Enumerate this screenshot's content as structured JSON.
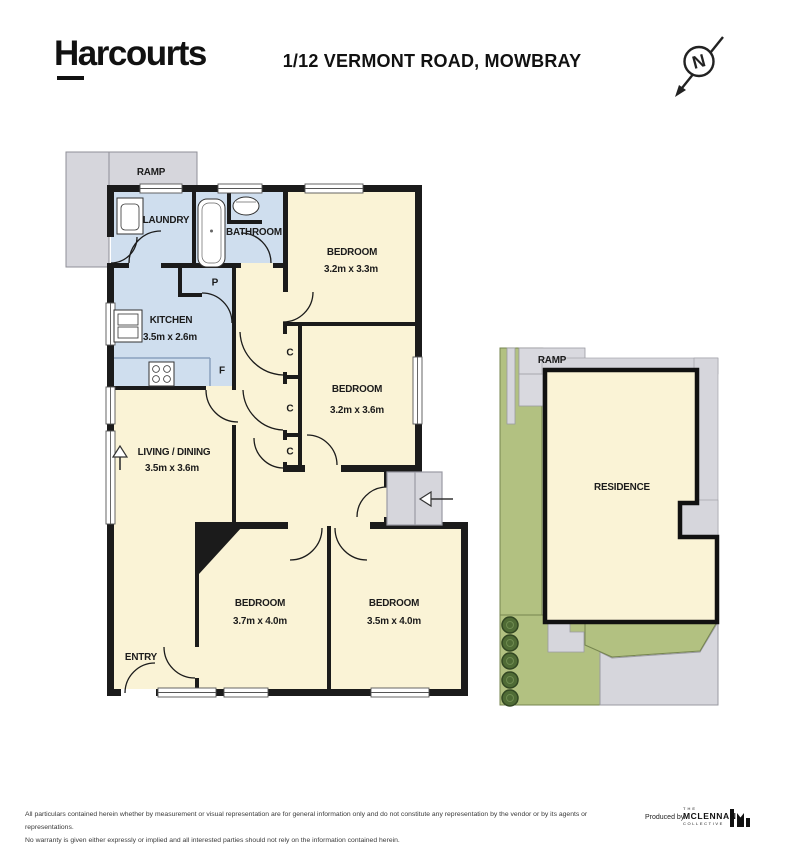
{
  "header": {
    "logo": "Harcourts",
    "title": "1/12 VERMONT ROAD, MOWBRAY",
    "compass_letter": "N"
  },
  "floor_plan": {
    "rooms": {
      "ramp": {
        "label": "RAMP"
      },
      "laundry": {
        "label": "LAUNDRY"
      },
      "bathroom": {
        "label": "BATHROOM"
      },
      "kitchen": {
        "label": "KITCHEN",
        "dims": "3.5m x 2.6m"
      },
      "bedroom1": {
        "label": "BEDROOM",
        "dims": "3.2m x 3.3m"
      },
      "bedroom2": {
        "label": "BEDROOM",
        "dims": "3.2m x 3.6m"
      },
      "living": {
        "label": "LIVING / DINING",
        "dims": "3.5m x 3.6m"
      },
      "bedroom3": {
        "label": "BEDROOM",
        "dims": "3.7m x 4.0m"
      },
      "bedroom4": {
        "label": "BEDROOM",
        "dims": "3.5m x 4.0m"
      },
      "entry": {
        "label": "ENTRY"
      }
    },
    "markers": {
      "pantry": "P",
      "fridge": "F",
      "closet": "C"
    }
  },
  "site_plan": {
    "ramp_label": "RAMP",
    "residence_label": "RESIDENCE"
  },
  "footer": {
    "disclaimer_line1": "All particulars contained herein whether by measurement or visual representation are for general information only and do not constitute any representation by the vendor or by its agents or representations.",
    "disclaimer_line2": "No warranty is given either expressly or implied and all interested parties should not rely on the information contained herein.",
    "produced_by": "Produced by",
    "brand_top": "THE",
    "brand_name": "MCLENNAN",
    "brand_bottom": "COLLECTIVE"
  },
  "colors": {
    "wall": "#1b1b1b",
    "room_cream": "#faf3d6",
    "wet_area_blue": "#cfdeee",
    "ramp_gray": "#d6d6dc",
    "lawn_green": "#b2c181",
    "bush_green": "#4f6b35"
  }
}
